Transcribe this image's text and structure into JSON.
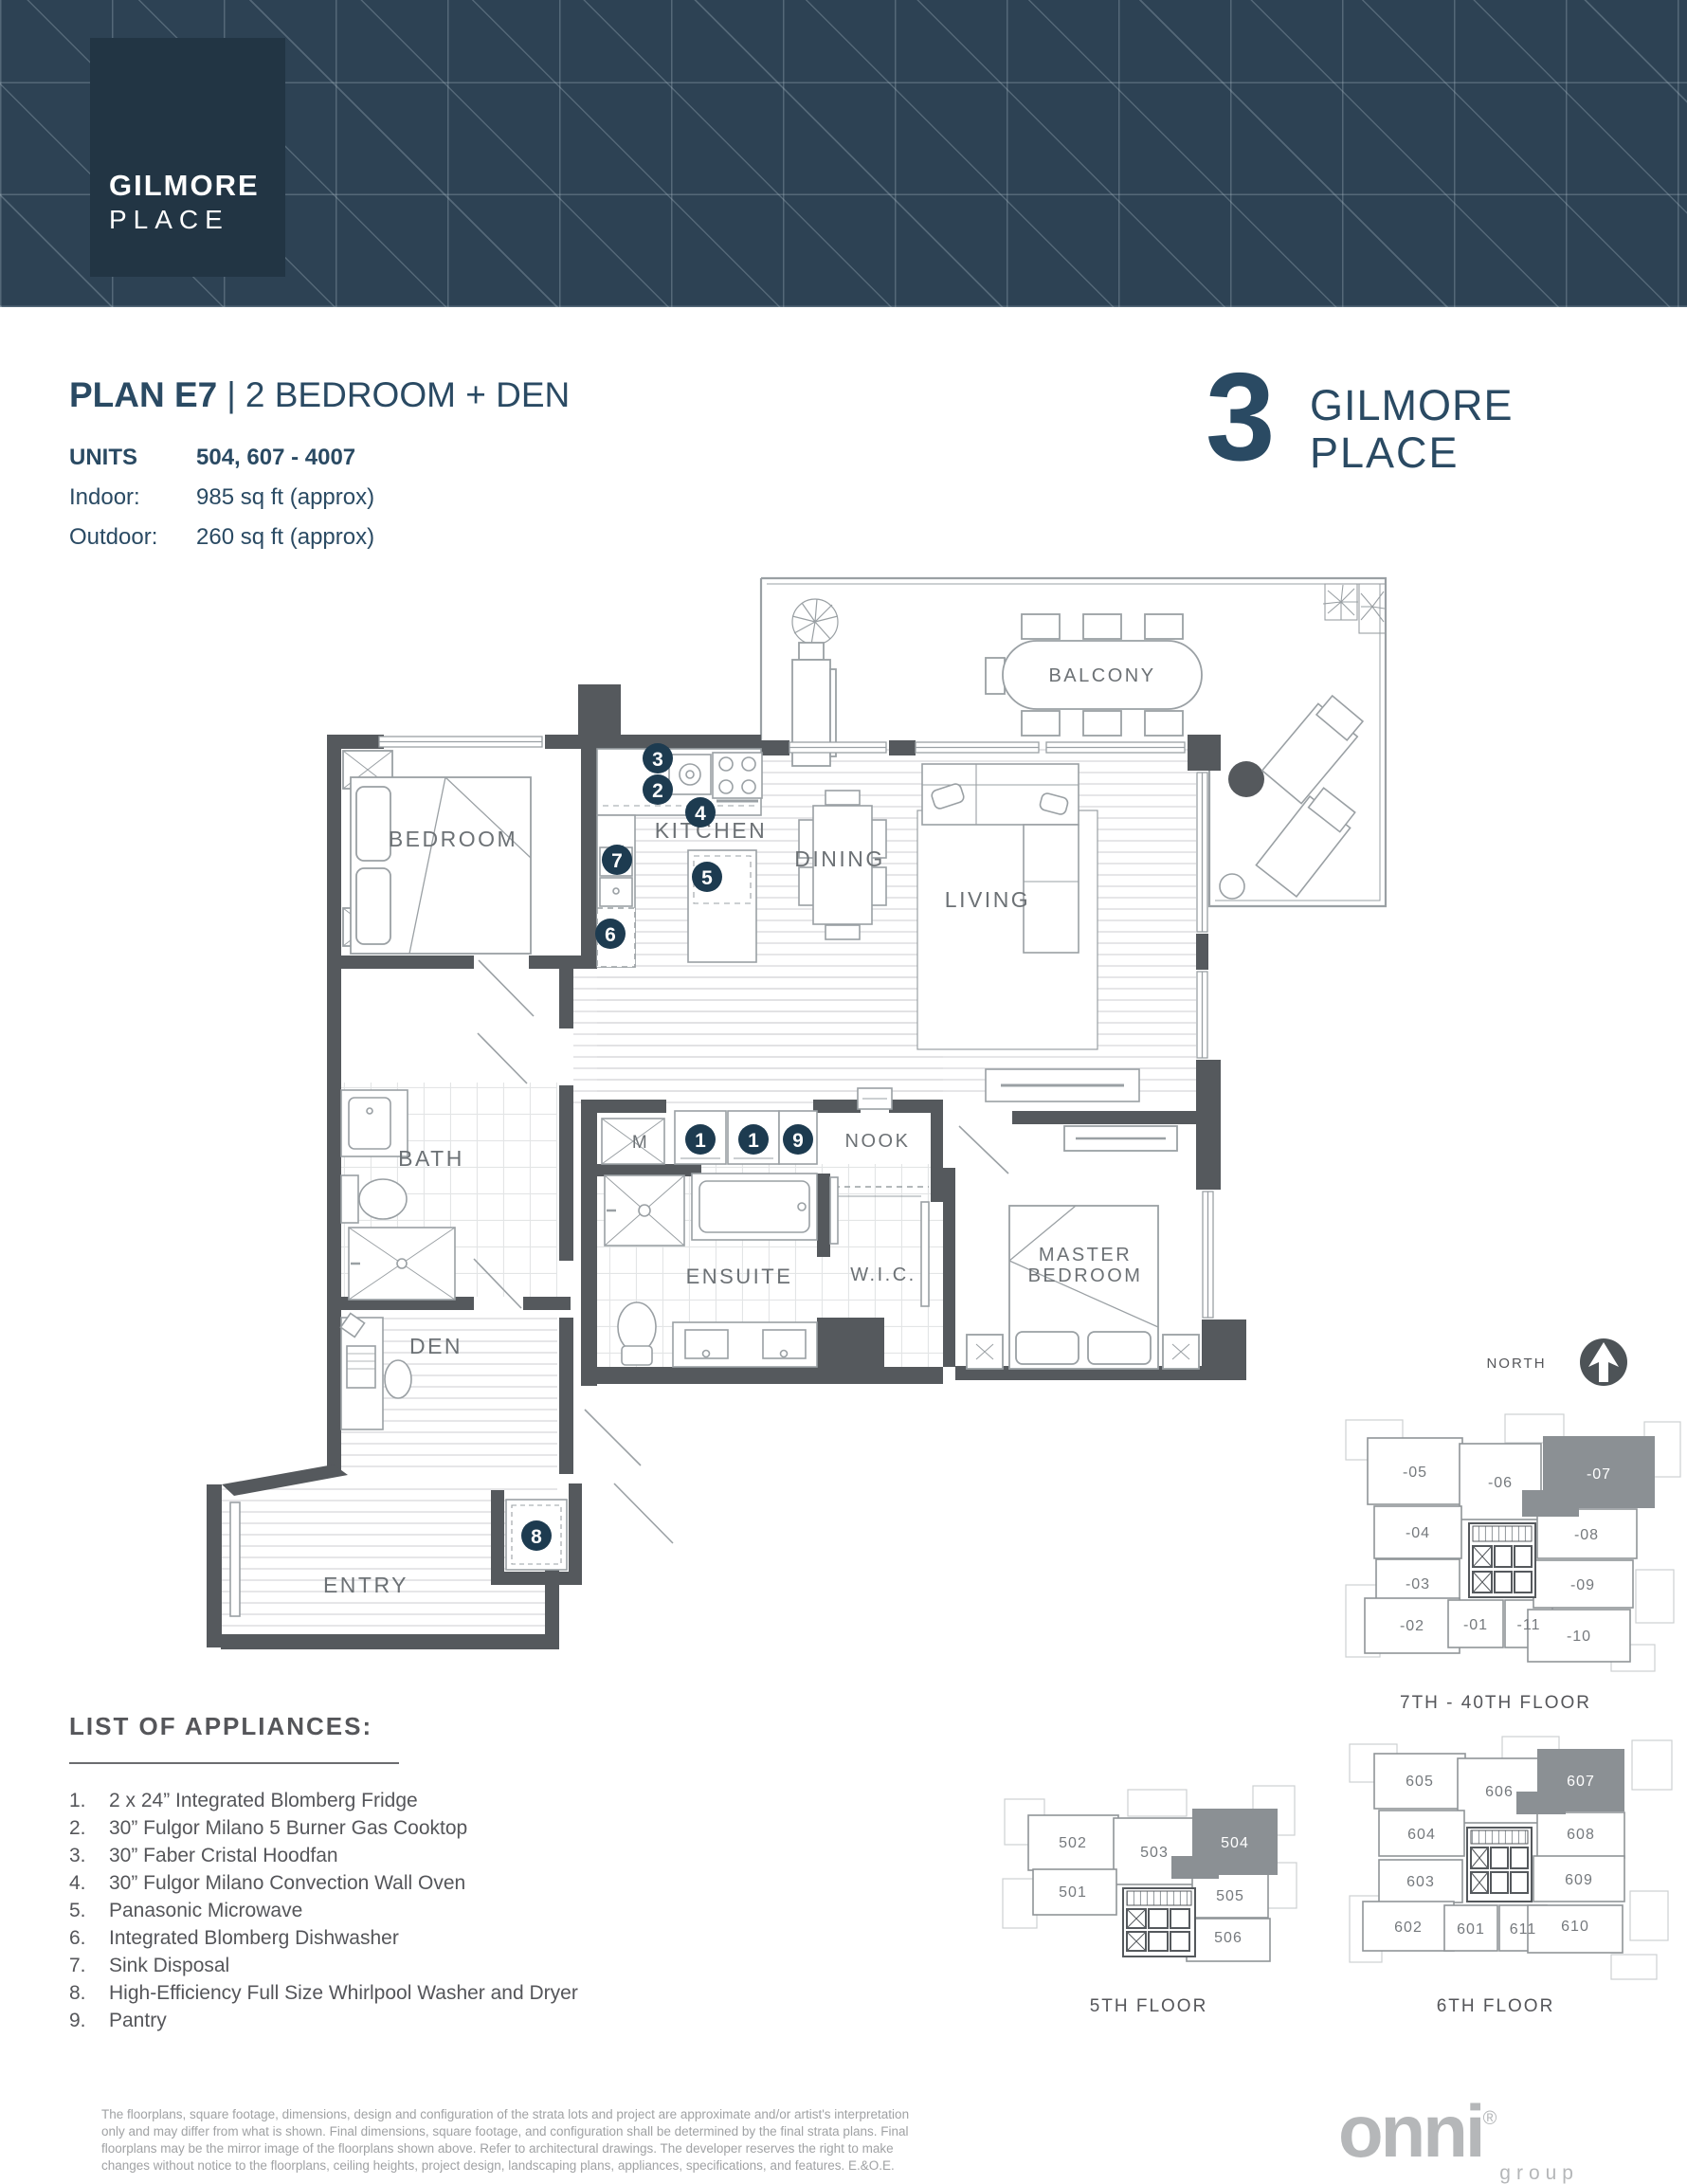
{
  "header": {
    "logo_line1": "GILMORE",
    "logo_line2": "PLACE"
  },
  "title": {
    "plan": "PLAN E7",
    "divider": "|",
    "subtitle": "2 BEDROOM + DEN"
  },
  "details": {
    "units_label": "UNITS",
    "units_value": "504, 607 - 4007",
    "indoor_label": "Indoor:",
    "indoor_value": "985 sq ft (approx)",
    "outdoor_label": "Outdoor:",
    "outdoor_value": "260 sq ft (approx)"
  },
  "building_logo": {
    "number": "3",
    "line1": "GILMORE",
    "line2": "PLACE"
  },
  "floorplan": {
    "rooms": {
      "balcony": "BALCONY",
      "bedroom": "BEDROOM",
      "kitchen": "KITCHEN",
      "dining": "DINING",
      "living": "LIVING",
      "bath": "BATH",
      "den": "DEN",
      "entry": "ENTRY",
      "ensuite": "ENSUITE",
      "wic": "W.I.C.",
      "nook": "NOOK",
      "master_line1": "MASTER",
      "master_line2": "BEDROOM",
      "m_closet": "M"
    },
    "markers": {
      "fridge": "1",
      "cooktop": "2",
      "hoodfan": "3",
      "oven": "4",
      "microwave": "5",
      "dishwasher": "6",
      "disposal": "7",
      "washer": "8",
      "pantry": "9"
    }
  },
  "north": {
    "label": "NORTH"
  },
  "keyplans": {
    "upper": {
      "caption": "7TH - 40TH FLOOR",
      "highlighted": "-07",
      "units": [
        "-05",
        "-06",
        "-07",
        "-04",
        "-08",
        "-03",
        "-09",
        "-02",
        "-01",
        "-11",
        "-10"
      ]
    },
    "fifth": {
      "caption": "5TH FLOOR",
      "highlighted": "504",
      "units": [
        "502",
        "503",
        "504",
        "501",
        "505",
        "506"
      ]
    },
    "sixth": {
      "caption": "6TH FLOOR",
      "highlighted": "607",
      "units": [
        "605",
        "606",
        "607",
        "604",
        "608",
        "603",
        "609",
        "602",
        "601",
        "611",
        "610"
      ]
    }
  },
  "appliances": {
    "heading": "LIST OF APPLIANCES:",
    "items": [
      {
        "num": "1.",
        "text": "2 x 24” Integrated Blomberg Fridge"
      },
      {
        "num": "2.",
        "text": "30” Fulgor Milano 5 Burner Gas Cooktop"
      },
      {
        "num": "3.",
        "text": "30” Faber Cristal Hoodfan"
      },
      {
        "num": "4.",
        "text": "30” Fulgor Milano Convection Wall Oven"
      },
      {
        "num": "5.",
        "text": "Panasonic Microwave"
      },
      {
        "num": "6.",
        "text": "Integrated Blomberg Dishwasher"
      },
      {
        "num": "7.",
        "text": "Sink Disposal"
      },
      {
        "num": "8.",
        "text": "High-Efficiency Full Size Whirlpool Washer and Dryer"
      },
      {
        "num": "9.",
        "text": "Pantry"
      }
    ]
  },
  "disclaimer": "The floorplans, square footage, dimensions, design and configuration of the strata lots and project are approximate and/or artist's interpretation only and may differ from what is shown. Final dimensions, square footage, and configuration shall be determined by the final strata plans. Final floorplans may be the mirror image of the floorplans shown above. Refer to architectural drawings. The developer reserves the right to make changes without notice to the floorplans, ceiling heights, project design, landscaping plans, appliances, specifications, and features. E.&O.E.",
  "onni": {
    "name": "onni",
    "reg": "®",
    "group": "group"
  },
  "colors": {
    "navy": "#2a4a63",
    "banner": "#2d4254",
    "marker": "#1d3b50",
    "wall": "#55595d",
    "keyplan_highlight": "#8b9094",
    "body_gray": "#55565a"
  }
}
